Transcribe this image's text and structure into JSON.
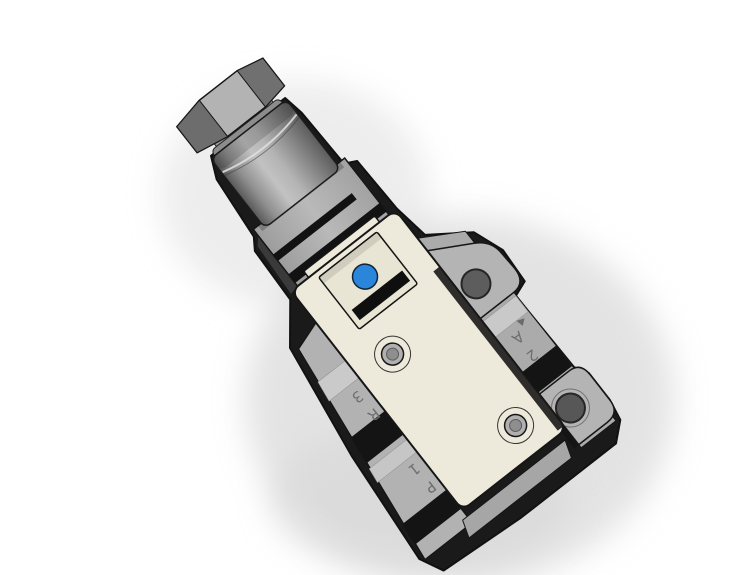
{
  "scene": {
    "type": "3d-cad-render",
    "subject": "Pneumatic solenoid valve with mounting plate, isometric CAD view",
    "background_color": "#ffffff"
  },
  "valve": {
    "body_color": "#edeadb",
    "recess_color": "#e8e5d4",
    "metal_light": "#b4b4b4",
    "metal_mid": "#a9a9a9",
    "metal_dark": "#6d6d6d",
    "band_black": "#141414",
    "manual_override_color": "#2a86da",
    "port_labels": {
      "output": {
        "number": "2",
        "letter": "A"
      },
      "exhaust": {
        "number": "3",
        "letter": "R"
      },
      "supply": {
        "number": "1",
        "letter": "P"
      }
    }
  }
}
